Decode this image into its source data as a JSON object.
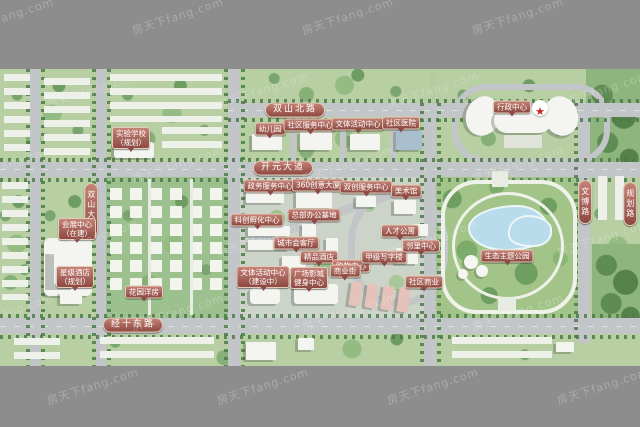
{
  "watermark": {
    "text": "房天下fang.com"
  },
  "colors": {
    "background_bar": "#8d8d8d",
    "map_green": "#b4cda0",
    "road_gray": "#c2c6c8",
    "label_red": "#8e4a42",
    "lake_blue": "#b9dcec",
    "star_red": "#cf1f1f"
  },
  "map": {
    "road_labels": [
      {
        "id": "road-north",
        "text": "双山北路",
        "x": 295,
        "y": 41,
        "type": "pill"
      },
      {
        "id": "road-middle",
        "text": "开元大道",
        "x": 283,
        "y": 99,
        "type": "pill"
      },
      {
        "id": "road-south",
        "text": "经十东路",
        "x": 133,
        "y": 256,
        "type": "pill"
      },
      {
        "id": "road-west",
        "text": "双山大街",
        "x": 91,
        "y": 141,
        "type": "pill-v"
      },
      {
        "id": "road-east",
        "text": "文博路",
        "x": 585,
        "y": 133,
        "type": "pill-v"
      },
      {
        "id": "road-far-east",
        "text": "规划路",
        "x": 630,
        "y": 135,
        "type": "pill-v"
      }
    ],
    "site_labels": [
      {
        "text": "实验学校\n（规划）",
        "x": 131,
        "y": 69
      },
      {
        "text": "幼儿园",
        "x": 270,
        "y": 60
      },
      {
        "text": "社区服务中心",
        "x": 310,
        "y": 56
      },
      {
        "text": "文体活动中心",
        "x": 358,
        "y": 55
      },
      {
        "text": "社区医院",
        "x": 401,
        "y": 54
      },
      {
        "text": "行政中心",
        "x": 512,
        "y": 38
      },
      {
        "text": "会展中心\n（在建）",
        "x": 77,
        "y": 160
      },
      {
        "text": "星级酒店\n（规划）",
        "x": 75,
        "y": 208
      },
      {
        "text": "花园洋房",
        "x": 144,
        "y": 223
      },
      {
        "text": "政务服务中心",
        "x": 270,
        "y": 117
      },
      {
        "text": "360创意大厦",
        "x": 318,
        "y": 116
      },
      {
        "text": "双创服务中心",
        "x": 366,
        "y": 118
      },
      {
        "text": "美术馆",
        "x": 406,
        "y": 122
      },
      {
        "text": "科创孵化中心",
        "x": 257,
        "y": 151
      },
      {
        "text": "总部办公基地",
        "x": 314,
        "y": 146
      },
      {
        "text": "城市会客厅",
        "x": 296,
        "y": 174
      },
      {
        "text": "精品酒店",
        "x": 319,
        "y": 188
      },
      {
        "text": "购物中心",
        "x": 351,
        "y": 197
      },
      {
        "text": "甲级写字楼",
        "x": 384,
        "y": 188
      },
      {
        "text": "人才公寓",
        "x": 400,
        "y": 162
      },
      {
        "text": "邻里中心",
        "x": 421,
        "y": 177
      },
      {
        "text": "社区商业",
        "x": 424,
        "y": 213
      },
      {
        "text": "文体活动中心\n（建设中）",
        "x": 263,
        "y": 208
      },
      {
        "text": "广场影城\n健身中心",
        "x": 309,
        "y": 209
      },
      {
        "text": "商业街",
        "x": 345,
        "y": 202
      },
      {
        "text": "生态主题公园",
        "x": 507,
        "y": 187
      }
    ]
  }
}
